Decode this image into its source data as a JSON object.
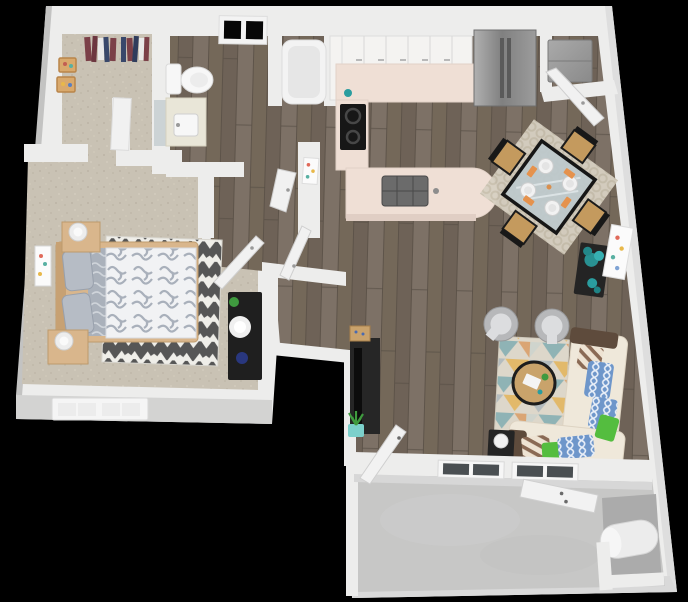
{
  "scene": {
    "type": "3d-floorplan-render",
    "rooms": [
      {
        "id": "closet",
        "label": "walk-in closet"
      },
      {
        "id": "bedroom",
        "label": "bedroom"
      },
      {
        "id": "bathroom",
        "label": "bathroom"
      },
      {
        "id": "hallway",
        "label": "hallway"
      },
      {
        "id": "kitchen",
        "label": "kitchen"
      },
      {
        "id": "laundry",
        "label": "laundry closet"
      },
      {
        "id": "dining",
        "label": "dining area"
      },
      {
        "id": "living",
        "label": "living room"
      },
      {
        "id": "patio",
        "label": "patio"
      },
      {
        "id": "storage",
        "label": "water heater closet"
      }
    ],
    "furniture": [
      "bed",
      "nightstand",
      "dresser",
      "chevron rug",
      "toilet",
      "vanity sink",
      "bathtub",
      "upper cabinets",
      "range cooktop",
      "kitchen island sink",
      "refrigerator",
      "washer dryer",
      "dining table",
      "dining chair",
      "console table",
      "tv stand",
      "barrel chair",
      "coffee table",
      "sectional sofa",
      "end table",
      "area rug",
      "water heater",
      "hanging clothes"
    ]
  },
  "palette": {
    "bg": "#000000",
    "wallTop": "#ededec",
    "wallFace": "#d3d3d2",
    "wallFaceDark": "#c3c3c2",
    "carpet": "#c9c2b4",
    "wood": "#776b5f",
    "concrete": "#c7c7c6",
    "counter": "#efdfd5",
    "counterEdge": "#e0cec4",
    "cabinet": "#f4f3f1",
    "fridgeGray": "#969696",
    "applianceBlack": "#171717",
    "woodFurn": "#d9b68c",
    "woodFurnDark": "#bf9c6e",
    "duvetWhite": "#f1f2f4",
    "duvetGray": "#aab1bb",
    "chevDark": "#565656",
    "chevLight": "#efeee9",
    "sofaCream": "#efe8da",
    "pillowBlue": "#6e96ca",
    "pillowGreen": "#54bd3f",
    "throwBrown": "#5e4b3c",
    "teal": "#2a9d9f",
    "plantGreen": "#3f9a3f",
    "rugLiving": "#ddd7ca",
    "rugDining": "#d7d0c2",
    "chairGray": "#b7b8ba",
    "chairGrayLight": "#dcdddf",
    "tableBlack": "#1b1b1b",
    "glass": "#bdc9cc",
    "napkinOrange": "#e5924d",
    "porcelain": "#f7f7f7",
    "mirror": "#ccd3d5",
    "darkFurn": "#242424"
  }
}
